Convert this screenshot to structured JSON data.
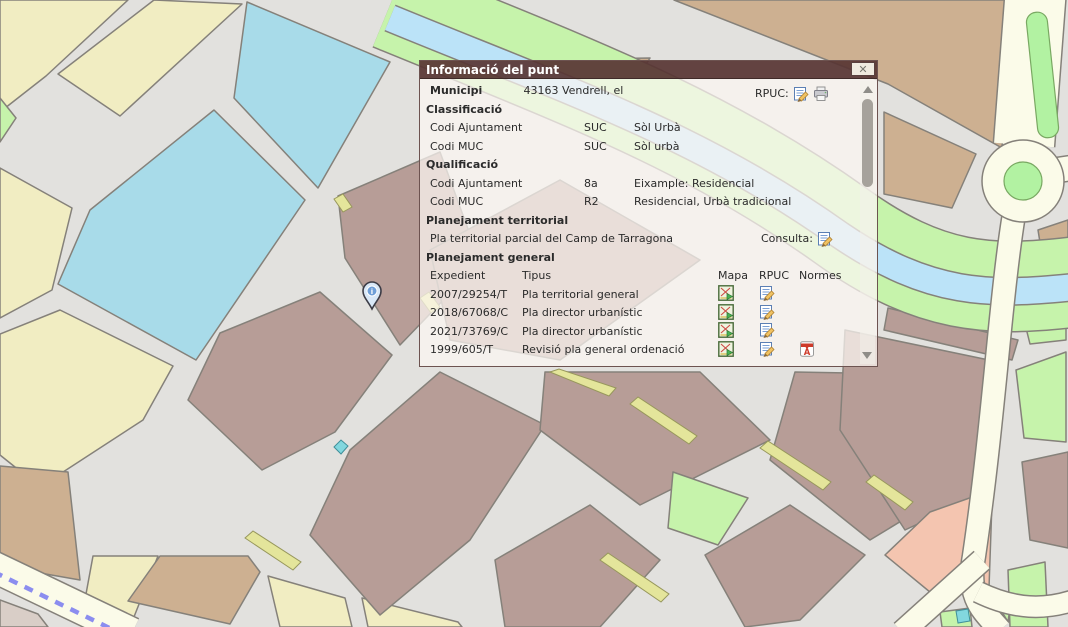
{
  "dialog": {
    "title": "Informació del punt",
    "close_glyph": "✕",
    "municipi": {
      "label": "Municipi",
      "value": "43163 Vendrell, el",
      "rpuc_label": "RPUC:"
    },
    "classificacio": {
      "heading": "Classificació",
      "rows": [
        {
          "label": "Codi Ajuntament",
          "code": "SUC",
          "desc": "Sòl Urbà"
        },
        {
          "label": "Codi MUC",
          "code": "SUC",
          "desc": "Sòl urbà"
        }
      ]
    },
    "qualificacio": {
      "heading": "Qualificació",
      "rows": [
        {
          "label": "Codi Ajuntament",
          "code": "8a",
          "desc": "Eixample: Residencial"
        },
        {
          "label": "Codi MUC",
          "code": "R2",
          "desc": "Residencial, Urbà tradicional"
        }
      ]
    },
    "territorial": {
      "heading": "Planejament territorial",
      "text": "Pla territorial parcial del Camp de Tarragona",
      "consulta_label": "Consulta:"
    },
    "general": {
      "heading": "Planejament general",
      "columns": {
        "expedient": "Expedient",
        "tipus": "Tipus",
        "mapa": "Mapa",
        "rpuc": "RPUC",
        "normes": "Normes"
      },
      "rows": [
        {
          "expedient": "2007/29254/T",
          "tipus": "Pla territorial general",
          "mapa": true,
          "rpuc": true,
          "normes": false
        },
        {
          "expedient": "2018/67068/C",
          "tipus": "Pla director urbanístic",
          "mapa": true,
          "rpuc": true,
          "normes": false
        },
        {
          "expedient": "2021/73769/C",
          "tipus": "Pla director urbanístic",
          "mapa": true,
          "rpuc": true,
          "normes": false
        },
        {
          "expedient": "1999/605/T",
          "tipus": "Revisió pla general ordenació",
          "mapa": true,
          "rpuc": true,
          "normes": true
        }
      ]
    }
  },
  "map": {
    "marker": "info-pin",
    "colors": {
      "road_base": "#e2e1de",
      "block_yellow": "#f1edc2",
      "block_blue": "#a8dbe9",
      "block_tan": "#cdb091",
      "block_mauve": "#b79d97",
      "block_green": "#c6f3ab",
      "block_salmon": "#f4c5b0",
      "khaki_strip": "#e4e59b",
      "stream_blue": "#bbe3f8",
      "cream_road": "#fbfbe9",
      "rail_dash_blue": "#8b8def",
      "dialog_titlebar": "#583533"
    }
  }
}
